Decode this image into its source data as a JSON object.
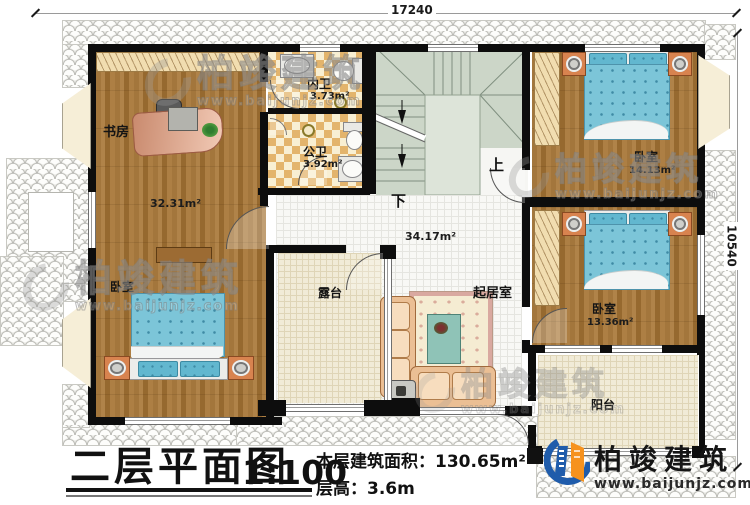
{
  "dimensions": {
    "width_label": "17240",
    "height_label": "10540"
  },
  "rooms": {
    "study": {
      "label": "书房",
      "area": "32.31m²"
    },
    "inner_bath": {
      "label": "内卫",
      "area": "3.73m²"
    },
    "public_bath": {
      "label": "公卫",
      "area": "3.92m²"
    },
    "hall": {
      "area": "34.17m²",
      "up": "上",
      "down": "下"
    },
    "bedroom_left": {
      "label": "卧室"
    },
    "bedroom_top_right": {
      "label": "卧室",
      "area": "14.13m²"
    },
    "bedroom_right": {
      "label": "卧室",
      "area": "13.36m²"
    },
    "terrace": {
      "label": "露台"
    },
    "living": {
      "label": "起居室"
    },
    "balcony": {
      "label": "阳台"
    }
  },
  "title_block": {
    "title": "二层平面图",
    "scale": "1:100",
    "floor_area": "本层建筑面积：130.65m²",
    "floor_height": "层高：3.6m"
  },
  "brand": {
    "name": "柏竣建筑",
    "url": "www.baijunjz.com"
  },
  "colors": {
    "wall": "#0d0d0d",
    "wood": "#a87c42",
    "bath_tile": "#e3b46c",
    "stair": "#ccd6c8",
    "terrace": "#f1ebd7",
    "logo_blue": "#1f5cab",
    "logo_orange": "#f6921e"
  }
}
